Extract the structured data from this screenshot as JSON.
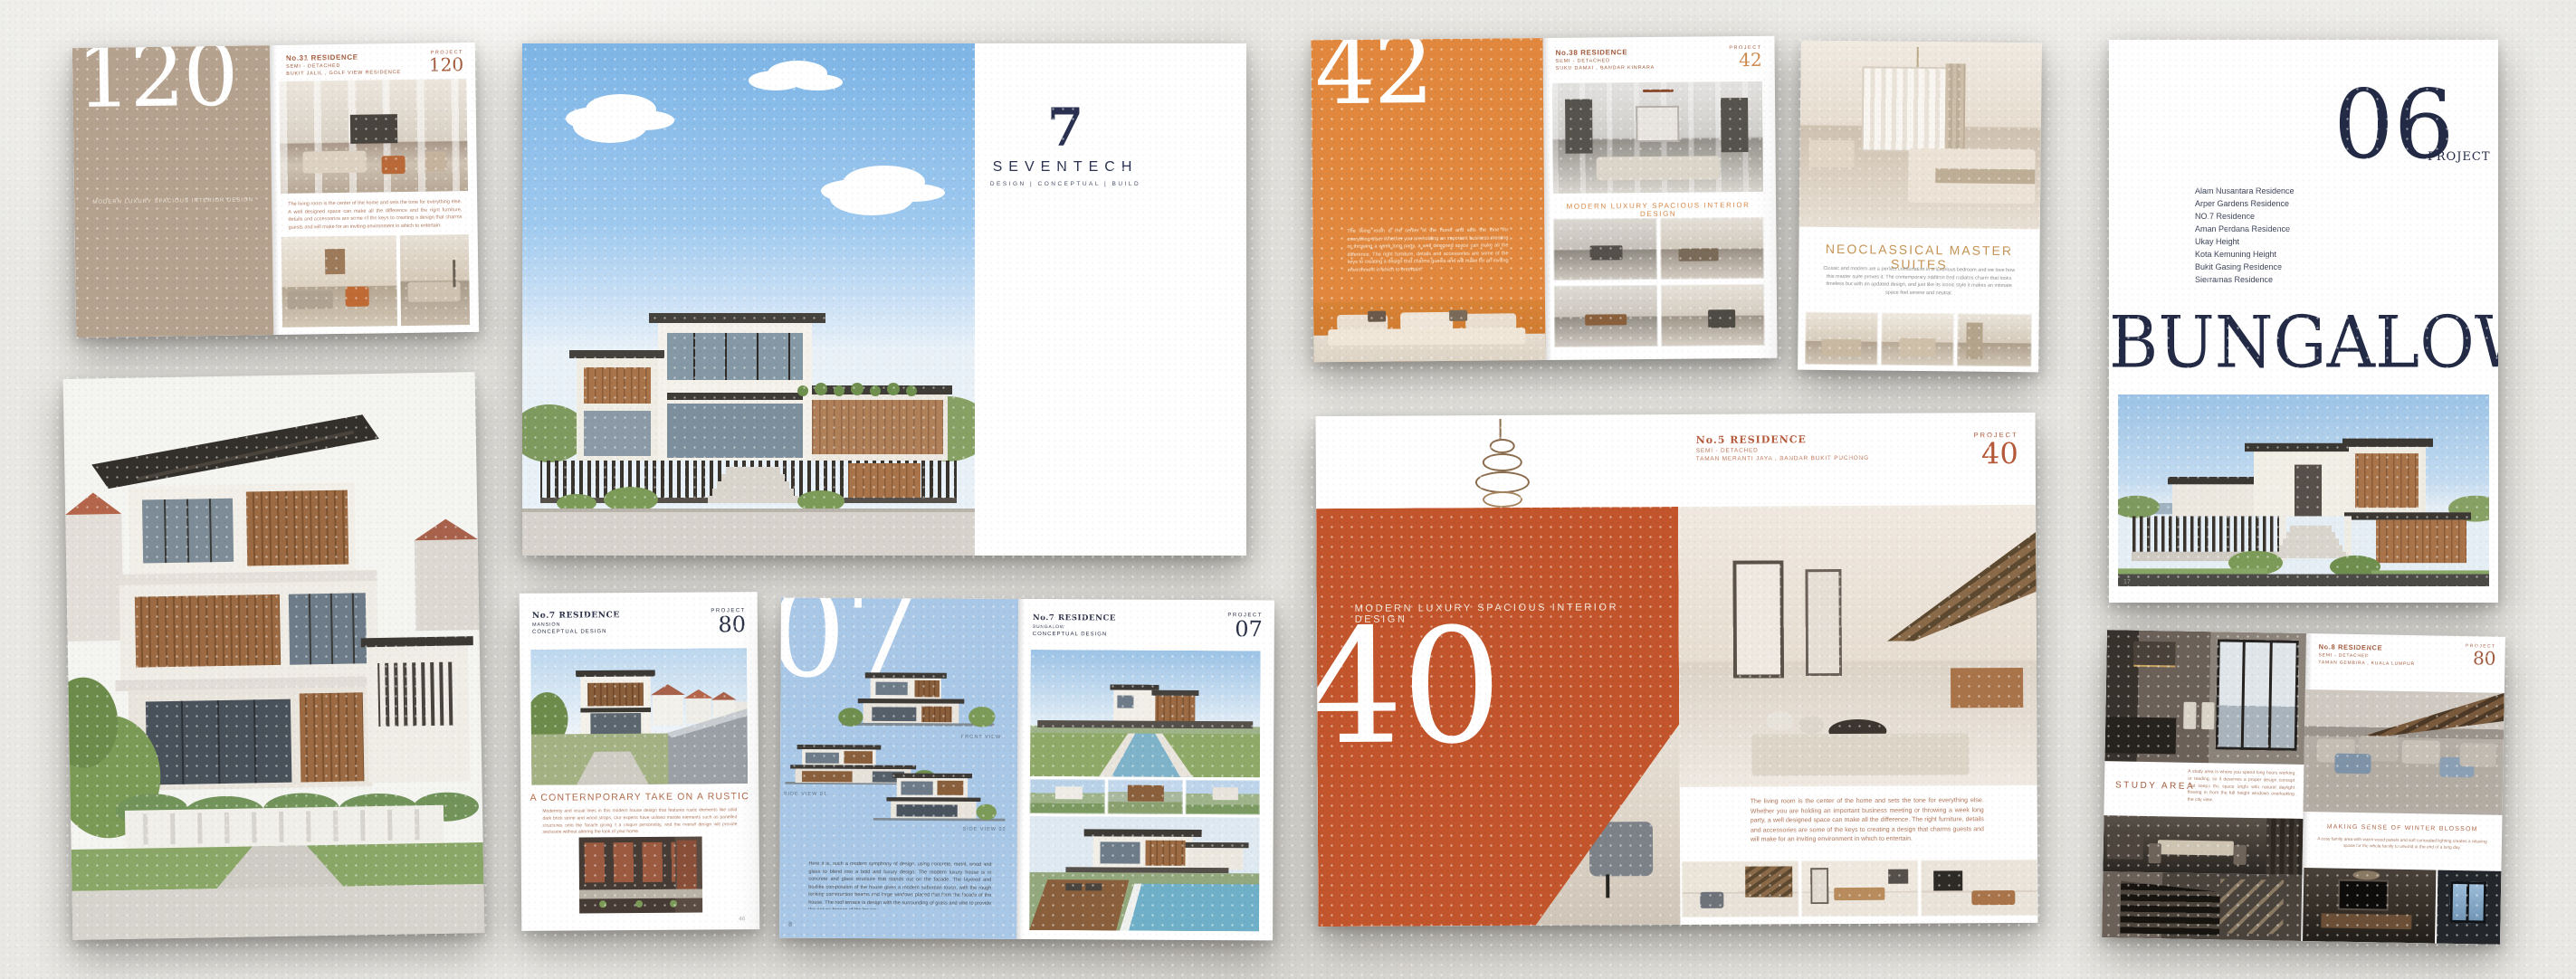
{
  "colors": {
    "tan": "#b5a28e",
    "orange": "#e1883e",
    "rust": "#c2552b",
    "navy": "#232a45",
    "gold": "#c49455",
    "blue_page": "#a9c7e6",
    "rust_text": "#a25a3c"
  },
  "seventech": {
    "number": "7",
    "name": "SEVENTECH",
    "tagline": "DESIGN   |   CONCEPTUAL   |   BUILD"
  },
  "card120": {
    "number": "120",
    "tagline": "MODERN LUXURY SPACIOUS INTERIOR DESIGN",
    "header": {
      "name": "No.31 RESIDENCE",
      "type": "SEMI - DETACHED",
      "location": "BUKIT JALIL , GOLF VIEW RESIDENCE",
      "project_label": "PROJECT",
      "project_number": "120"
    },
    "body": "The living room is the center of the home and sets the tone for everything else. A well designed space can make all the difference and the right furniture, details and accessories are some of the keys to creating a design that charms guests and will make for an inviting environment in which to entertain."
  },
  "spread42": {
    "number": "42",
    "intro": "The living room is the center of the home and sets the tone for everything else. Whether you are holding an important business meeting or throwing a week long party, a well designed space can make all the difference. The right furniture, details and accessories are some of the keys to creating a design that charms guests and will make for an inviting environment in which to entertain.",
    "header": {
      "name": "No.38 RESIDENCE",
      "type": "SEMI - DETACHED",
      "location": "SUKU DAMAI , BANDAR KINRARA",
      "project_label": "PROJECT",
      "project_number": "42"
    },
    "caption": "MODERN LUXURY SPACIOUS INTERIOR DESIGN"
  },
  "neoclassical": {
    "title": "NEOCLASSICAL MASTER SUITES",
    "body": "Classic and modern are a perfect combination in a luxurious bedroom and we love how this master suite proves it. The contemporary addition bed radiates charm that looks timeless but with an updated design, and just like its iconic style it makes an intimate space feel serene and neutral."
  },
  "bungalow": {
    "number": "06",
    "project_label": "PROJECT",
    "projects": [
      "Alam Nusantara Residence",
      "Arper Gardens Residence",
      "NO.7 Residence",
      "Aman Perdana Residence",
      "Ukay Height",
      "Kota Kemuning Height",
      "Bukit Gasing Residence",
      "Sierramas Residence"
    ],
    "title": "BUNGALOW",
    "page_number": "17"
  },
  "project80": {
    "header": {
      "name": "No.7 RESIDENCE",
      "type": "MANSION",
      "stage": "CONCEPTUAL DESIGN",
      "project_label": "PROJECT",
      "project_number": "80"
    },
    "title": "A CONTERNPORARY TAKE ON A RUSTIC",
    "body": "Modernity and visual lines in this modern house design that features rustic elements like solid dark brick stone and wood straps. Our experts have utilised marble elements such as panelled structures onto the facade giving it a unique personality, and the overall design will provide seclusion without altering the look of your home.",
    "page_number": "46"
  },
  "spread07": {
    "number": "07",
    "captions": {
      "front": "FRONT VIEW",
      "side1": "SIDE VIEW 01",
      "side2": "SIDE VIEW 02"
    },
    "body": "Here it is, such a modern symphony of design, using concrete, metal, wood and glass to blend into a bold and luxury design. The modern luxury house is in concrete and glass structure that stands out on the facade. The layered and boxlike composition of the house gives a modern suburban touch, with the rough looking construction beams and large windows placed that form the facade of the house. The roof terrace is design with the surrounding of grass and vibe to provide the nature breeze of the house.",
    "page_number": "8",
    "header": {
      "name": "No.7 RESIDENCE",
      "type": "BUNGALOW",
      "stage": "CONCEPTUAL DESIGN",
      "project_label": "PROJECT",
      "project_number": "07"
    }
  },
  "spread40": {
    "caption": "MODERN LUXURY SPACIOUS INTERIOR DESIGN",
    "number": "40",
    "header": {
      "name": "No.5 RESIDENCE",
      "type": "SEMI - DETACHED",
      "location": "TAMAN MERANTI JAYA , BANDAR BUKIT PUCHONG",
      "project_label": "PROJECT",
      "project_number": "40"
    },
    "body": "The living room is the center of the home and sets the tone for everything else. Whether you are holding an important business meeting or throwing a week long party, a well designed space can make all the difference. The right furniture, details and accessories are some of the keys to creating a design that charms guests and will make for an inviting environment in which to entertain."
  },
  "spread80dark": {
    "study_title": "STUDY AREA",
    "study_body": "A study area is where you spend long hours working or reading, so it deserves a proper design concept that keeps the space bright with natural daylight flowing in from the full height windows overlooking the city view.",
    "header": {
      "name": "No.8 RESIDENCE",
      "type": "SEMI - DETACHED",
      "location": "TAMAN GEMBIRA , KUALA LUMPUR",
      "project_label": "PROJECT",
      "project_number": "80"
    },
    "caption": "MAKING SENSE OF WINTER BLOSSOM",
    "caption_body": "A cosy family area with warm wood panels and soft concealed lighting creates a relaxing space for the whole family to unwind at the end of a long day."
  }
}
